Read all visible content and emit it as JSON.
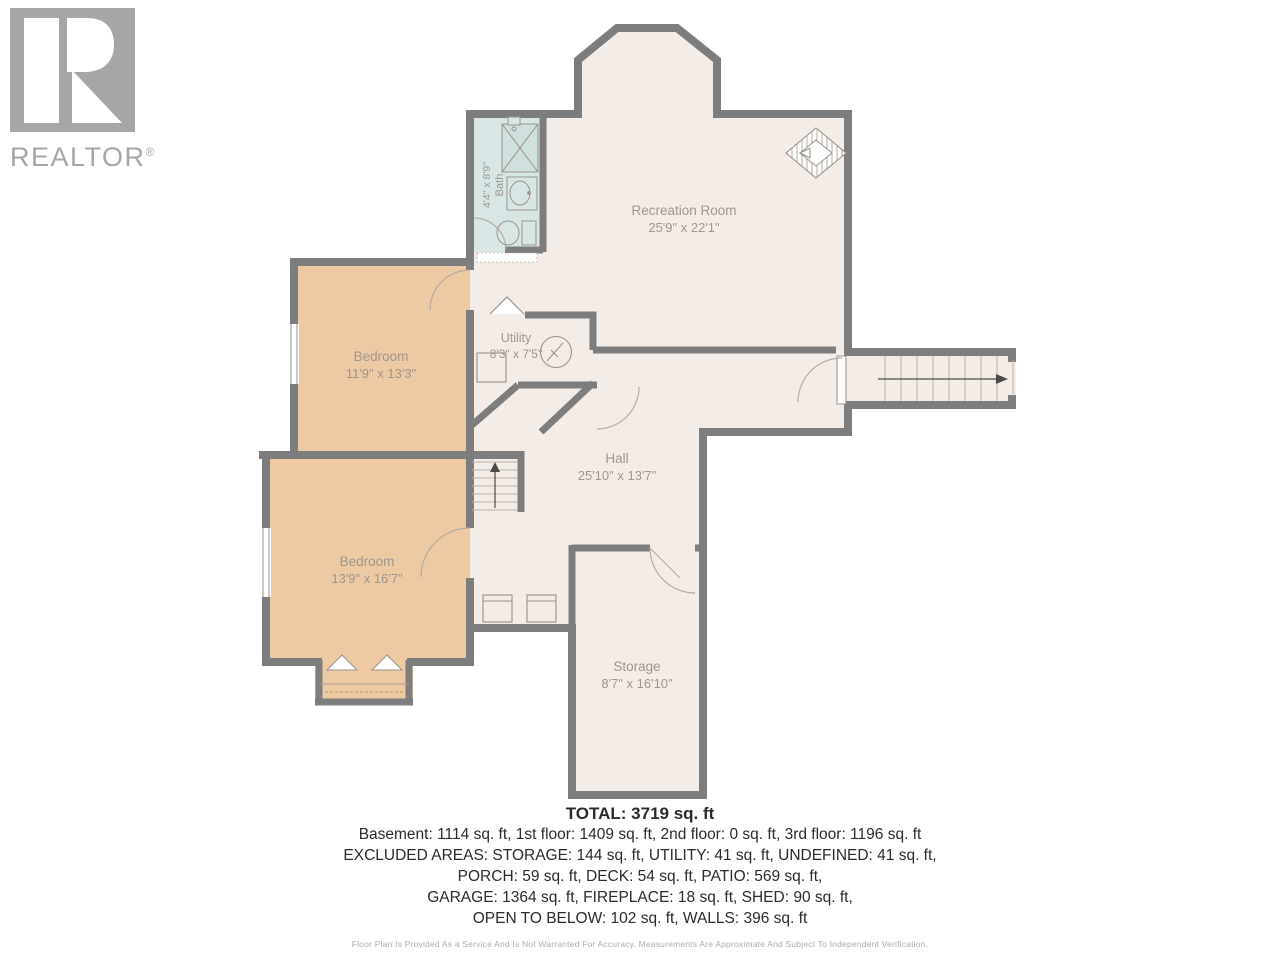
{
  "branding": {
    "logo_text": "REALTOR",
    "registered_mark": "®"
  },
  "rooms": {
    "recreation": {
      "name": "Recreation Room",
      "dims": "25'9\" x 22'1\""
    },
    "bath": {
      "name": "Bath",
      "dims": "4'4\" x 8'9\""
    },
    "bedroom1": {
      "name": "Bedroom",
      "dims": "11'9\" x 13'3\""
    },
    "bedroom2": {
      "name": "Bedroom",
      "dims": "13'9\" x 16'7\""
    },
    "utility": {
      "name": "Utility",
      "dims": "8'3\" x 7'5\""
    },
    "hall": {
      "name": "Hall",
      "dims": "25'10\" x 13'7\""
    },
    "storage": {
      "name": "Storage",
      "dims": "8'7\" x 16'10\""
    }
  },
  "summary": {
    "total": "TOTAL: 3719 sq. ft",
    "line1": "Basement: 1114 sq. ft, 1st floor: 1409 sq. ft, 2nd floor: 0 sq. ft, 3rd floor: 1196 sq. ft",
    "line2": "EXCLUDED AREAS: STORAGE: 144 sq. ft, UTILITY: 41 sq. ft, UNDEFINED: 41 sq. ft,",
    "line3": "PORCH: 59 sq. ft, DECK: 54 sq. ft, PATIO: 569 sq. ft,",
    "line4": "GARAGE: 1364 sq. ft, FIREPLACE: 18 sq. ft, SHED: 90 sq. ft,",
    "line5": "OPEN TO BELOW: 102 sq. ft, WALLS: 396 sq. ft"
  },
  "disclaimer": "Floor Plan Is Provided As a Service And Is Not Warranted For Accuracy. Measurements Are Approximate And Subject To Independent Verification.",
  "colors": {
    "wall": "#7d7d7d",
    "floor_main": "#f4ede7",
    "floor_bedroom": "#edc9a4",
    "floor_bath": "#d8e7e6",
    "label_text": "#9d968c",
    "logo_gray": "#a7a6a5",
    "summary_text": "#2b2b2b"
  }
}
